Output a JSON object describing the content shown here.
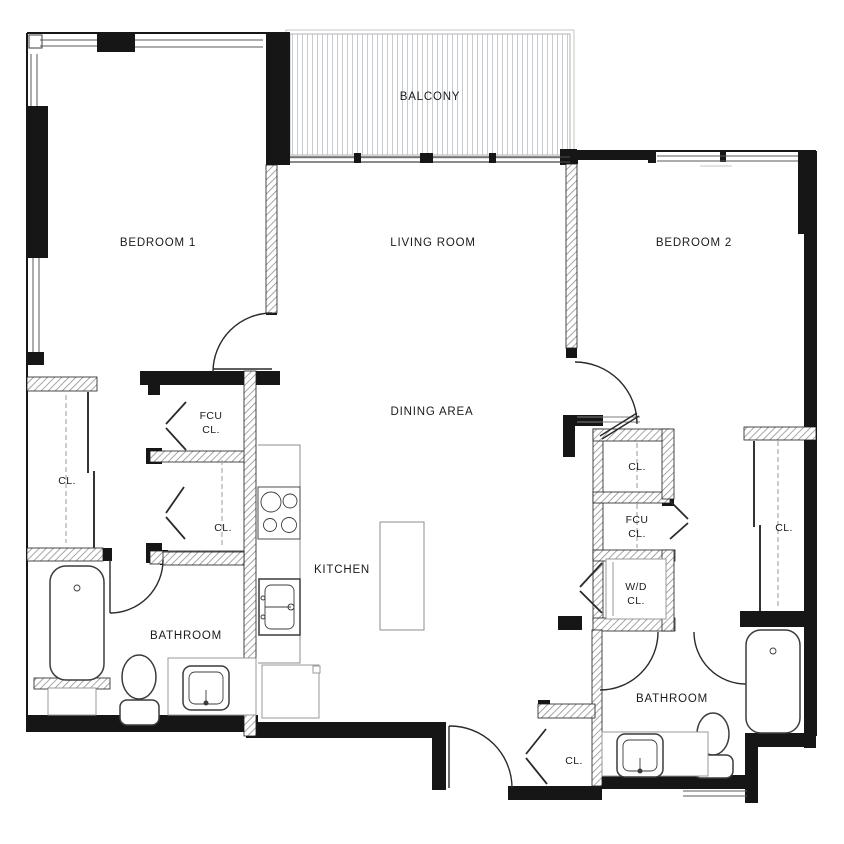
{
  "plan": {
    "title": "two-bedroom apartment floor plan",
    "rooms": {
      "balcony": "BALCONY",
      "bedroom1": "BEDROOM 1",
      "living": "LIVING ROOM",
      "bedroom2": "BEDROOM 2",
      "dining": "DINING AREA",
      "kitchen": "KITCHEN",
      "bathroom1": "BATHROOM",
      "bathroom2": "BATHROOM"
    },
    "closets": {
      "bedroom1_closet": "CL.",
      "hall_closet_lower": "CL.",
      "fcu_left_line1": "FCU",
      "fcu_left_line2": "CL.",
      "closet_right_top": "CL.",
      "fcu_right_line1": "FCU",
      "fcu_right_line2": "CL.",
      "wd_line1": "W/D",
      "wd_line2": "CL.",
      "bedroom2_closet": "CL.",
      "entry_closet": "CL."
    },
    "colors": {
      "wall": "#161616",
      "partition_hatch": "#8f8f8f",
      "fixture": "#3c3c3c",
      "light_fixture": "#9a9a9a",
      "balcony_hatch": "#c7ccd2",
      "background": "#ffffff",
      "text": "#1b1b1b"
    }
  }
}
